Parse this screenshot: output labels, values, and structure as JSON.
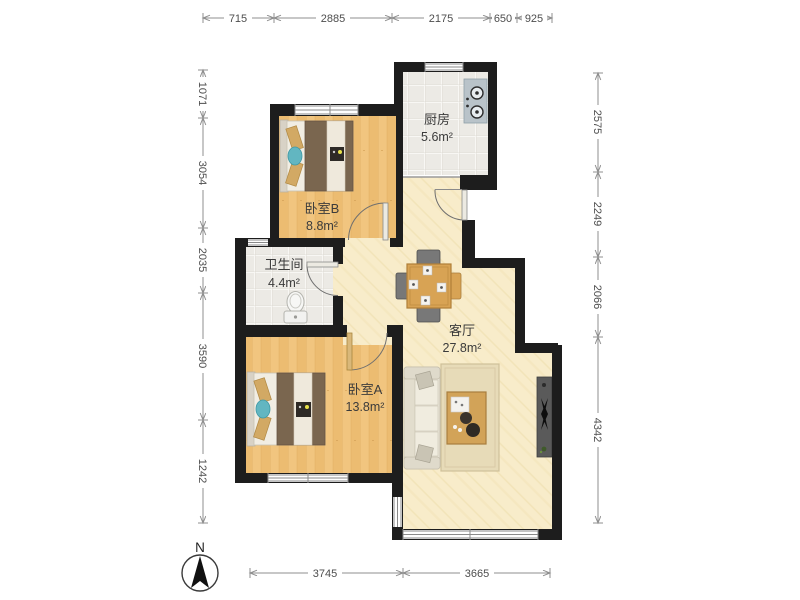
{
  "plan_title": "apartment-floor-plan",
  "rooms": {
    "kitchen": {
      "name": "厨房",
      "area": "5.6m²"
    },
    "bedroomB": {
      "name": "卧室B",
      "area": "8.8m²"
    },
    "bathroom": {
      "name": "卫生间",
      "area": "4.4m²"
    },
    "living": {
      "name": "客厅",
      "area": "27.8m²"
    },
    "bedroomA": {
      "name": "卧室A",
      "area": "13.8m²"
    }
  },
  "dims": {
    "top": [
      "715",
      "2885",
      "2175",
      "650",
      "925"
    ],
    "left": [
      "1071",
      "3054",
      "2035",
      "3590",
      "1242"
    ],
    "right": [
      "2575",
      "2249",
      "2066",
      "4342"
    ],
    "bottom": [
      "3745",
      "3665"
    ]
  },
  "compass": {
    "north_label": "N"
  },
  "colors": {
    "wall": "#1d1d1d",
    "wood_floor": "#f1c57f",
    "tile_floor": "#eceae5",
    "living_floor": "#f8ecca",
    "duvet_brown": "#7a664f",
    "pillow_tan": "#d2a964",
    "accent_teal": "#62b6c1",
    "dining_wood": "#d8a354",
    "dim_text": "#4d4d4d"
  }
}
